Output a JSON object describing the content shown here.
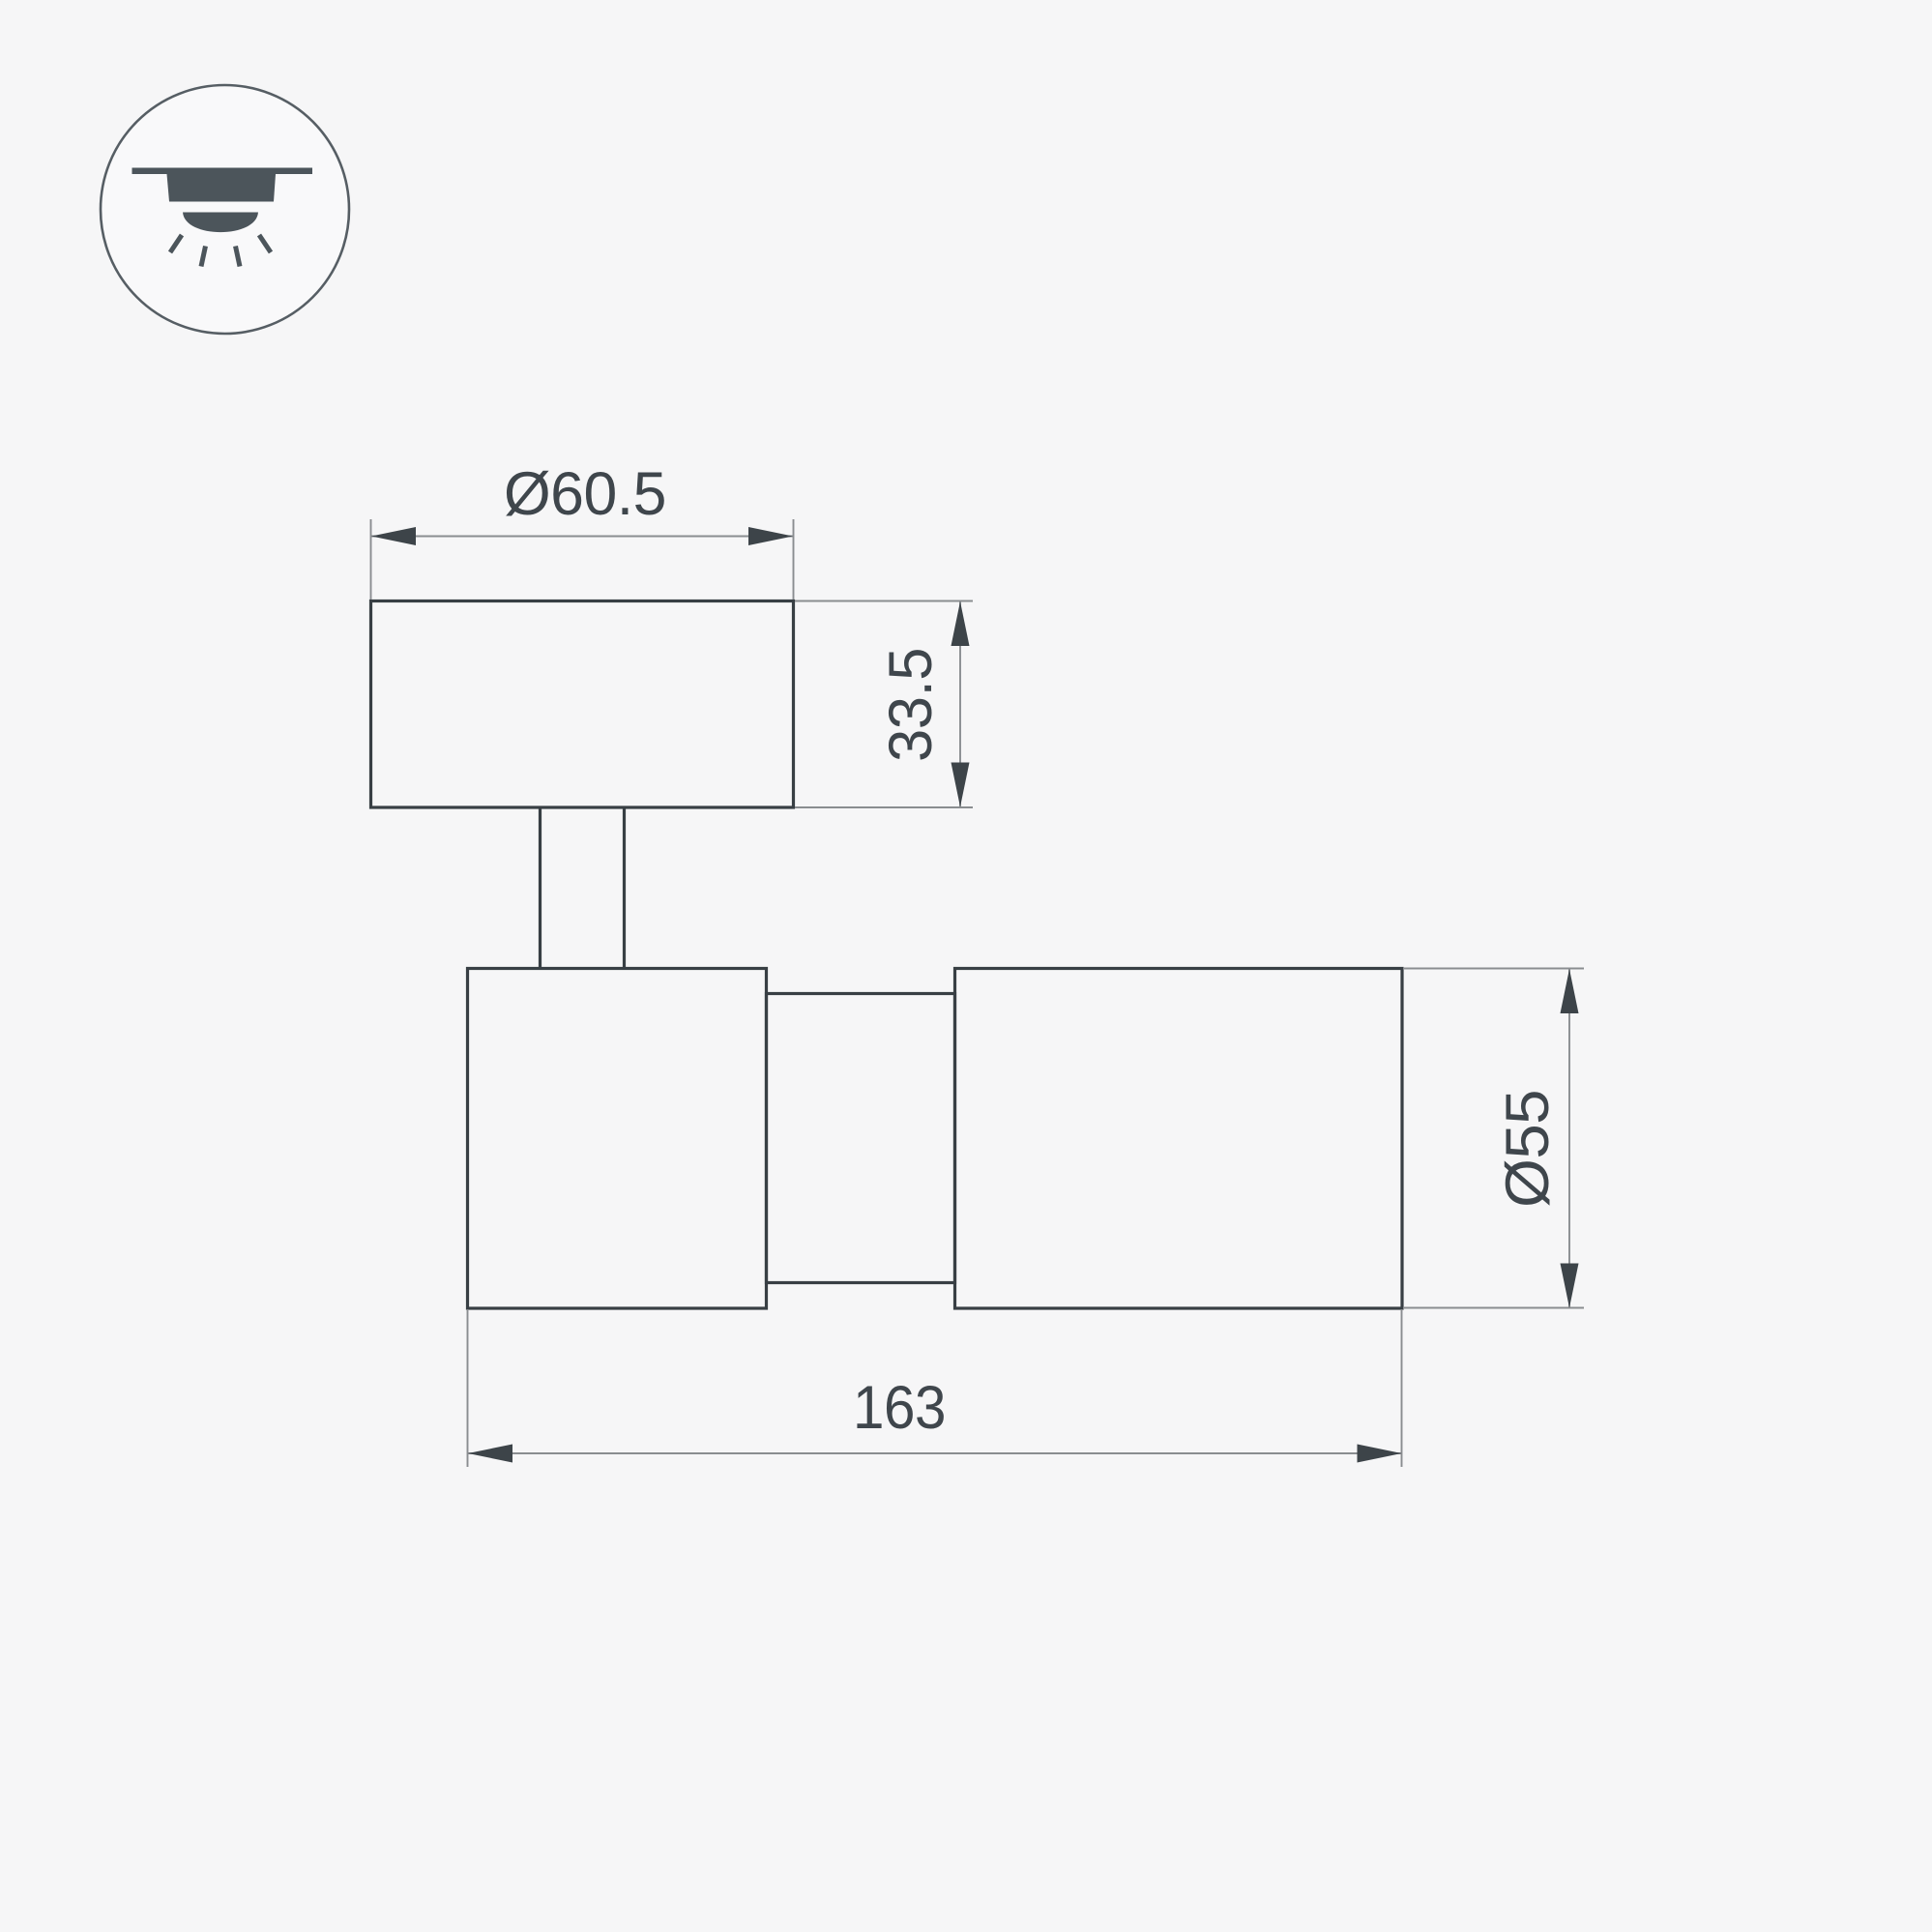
{
  "drawing": {
    "title": "spot-luminaire-dimension-drawing",
    "background_color": "#f6f6f7",
    "outline_color": "#383f44",
    "dimension_line_color": "#8a8d90",
    "text_color": "#3f464c",
    "icon_color": "#4c555b",
    "icon": {
      "name": "ceiling-surface-mount-downlight-icon"
    },
    "dimensions": {
      "top_diameter": {
        "label": "Ø60.5"
      },
      "base_height": {
        "label": "33.5"
      },
      "body_diameter": {
        "label": "Ø55"
      },
      "total_length": {
        "label": "163"
      }
    }
  }
}
